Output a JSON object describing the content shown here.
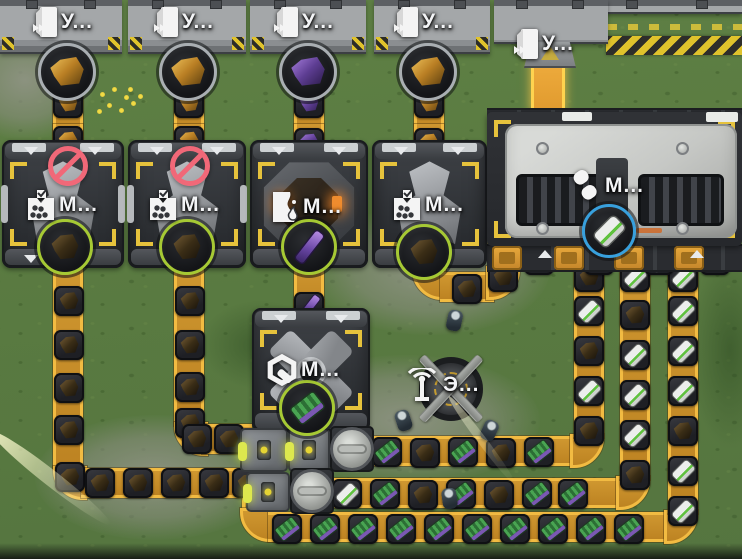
{
  "ports": [
    {
      "label": "У...",
      "ore": "gold-ore"
    },
    {
      "label": "У...",
      "ore": "gold-ore"
    },
    {
      "label": "У...",
      "ore": "purple-ore"
    },
    {
      "label": "У...",
      "ore": "gold-ore"
    },
    {
      "label": "У...",
      "ore": "none"
    }
  ],
  "machines": [
    {
      "label": "М...",
      "icon": "crusher-icon",
      "status": "no-power",
      "output_item": "dark-ore",
      "ring_color": "#a6c934"
    },
    {
      "label": "М...",
      "icon": "crusher-icon",
      "status": "no-power",
      "output_item": "dark-ore",
      "ring_color": "#a6c934"
    },
    {
      "label": "М...",
      "icon": "smelter-icon",
      "status": "ok",
      "output_item": "purple-rod",
      "ring_color": "#a6c934"
    },
    {
      "label": "М...",
      "icon": "crusher-icon",
      "status": "ok",
      "output_item": "dark-ore",
      "ring_color": "#a6c934"
    },
    {
      "label": "М...",
      "icon": "rollers-icon",
      "status": "ok",
      "output_item": "battery",
      "ring_color": "#38a0dd"
    },
    {
      "label": "М...",
      "icon": "assembler-icon",
      "status": "ok",
      "output_item": "circuit-board",
      "ring_color": "#a6c934"
    }
  ],
  "power_pole": {
    "label": "Э...",
    "icon": "antenna-icon"
  },
  "belt_item_kinds": [
    "gold-ore",
    "purple-ore",
    "dark-ore",
    "battery",
    "circuit-board",
    "purple-rod"
  ],
  "colors": {
    "belt": "#c8912a",
    "belt_edge": "#f2bb42",
    "belt_highlight": "#ffd34f",
    "ring_green": "#a6c934",
    "ring_blue": "#38a0dd",
    "prohibit": "#f16878",
    "accent_yellow": "#e6c23c",
    "hazard_yellow": "#ddbf2e",
    "grass": "#5c7d42"
  }
}
